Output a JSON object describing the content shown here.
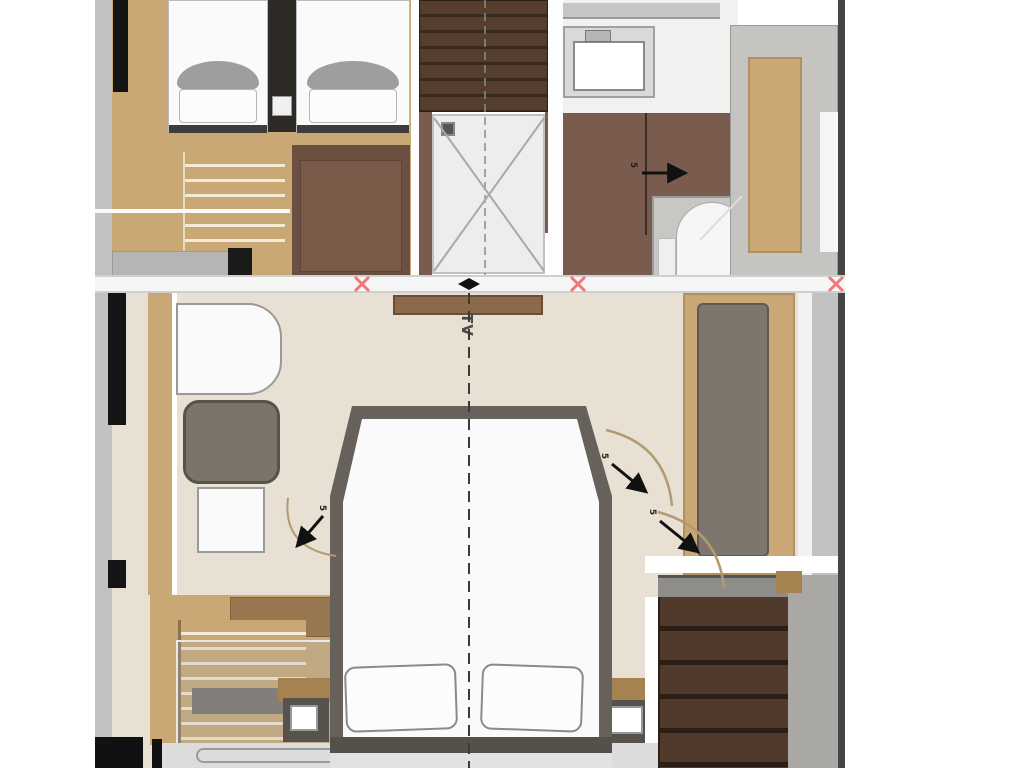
{
  "plan": {
    "tv_label": "TV",
    "door_notes": {
      "forward_bath": "5",
      "master_right_upper": "5",
      "master_right_lower": "5",
      "master_left": "5"
    },
    "palette": {
      "floor_cream": "#e8e0d2",
      "wood_tan": "#c9a876",
      "wood_mid": "#a5824f",
      "wood_brown": "#8a6a4a",
      "stair_brown": "#4e382a",
      "panel_brown": "#7a5c4e",
      "wardrobe_brown": "#6b4f41",
      "walkway_gray": "#c2c2c2",
      "platform_gray": "#c6c4c0",
      "frame_dark": "#57534c",
      "cushion_gray": "#7d766c",
      "chair_gray": "#7b7468",
      "mattress_white": "#fafafa",
      "line_dark": "#3a3a3a",
      "marker_red": "#f07878",
      "hull_black": "#151515"
    }
  }
}
